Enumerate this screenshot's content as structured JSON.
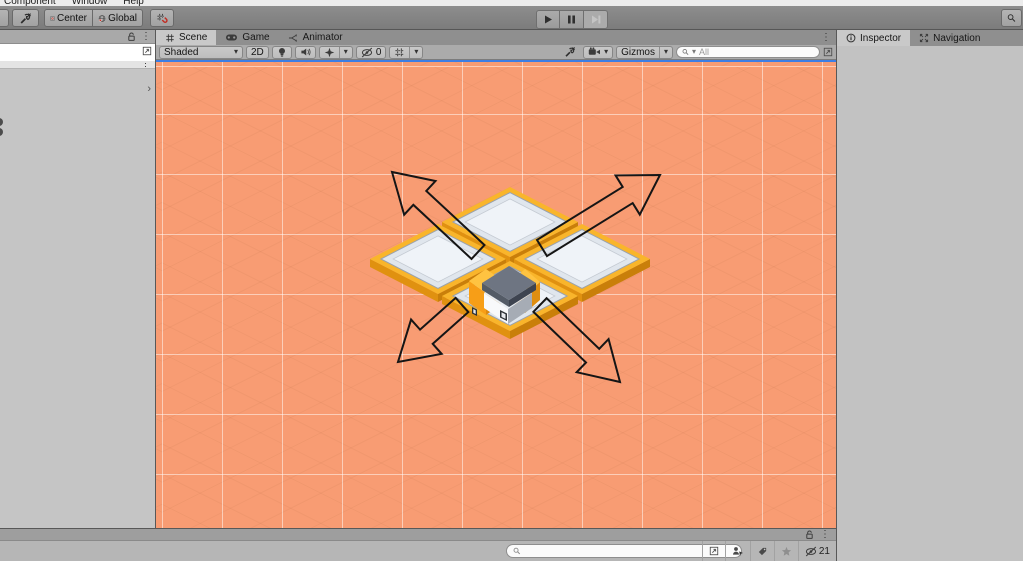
{
  "menu_bar": {
    "items": [
      "Component",
      "Window",
      "Help"
    ]
  },
  "main_toolbar": {
    "center_label": "Center",
    "global_label": "Global"
  },
  "scene_panel": {
    "tabs": [
      {
        "label": "Scene"
      },
      {
        "label": "Game"
      },
      {
        "label": "Animator"
      }
    ],
    "toolbar": {
      "draw_mode": "Shaded",
      "mode_2d_label": "2D",
      "hidden_count": "0",
      "gizmos_label": "Gizmos",
      "search_placeholder": "All",
      "search_value": ""
    }
  },
  "inspector_panel": {
    "tabs": [
      {
        "label": "Inspector"
      },
      {
        "label": "Navigation"
      }
    ]
  },
  "left_panel": {
    "search_value": "",
    "search_placeholder": ""
  },
  "bottom_panel": {
    "search_value": "",
    "search_placeholder": "",
    "hidden_count": "21"
  },
  "scene_view": {
    "tiles": 4,
    "arrows": [
      "up-left",
      "up-right",
      "down-left",
      "down-right"
    ],
    "object": "isometric-house"
  },
  "icons": {
    "kebab": "⋮",
    "caret": "▾",
    "chevron": "›"
  },
  "colors": {
    "scene_bg": "#F89C73",
    "tile_gold": "#F9B52B",
    "tile_gold_dark": "#E09110",
    "tile_gold_darker": "#C97F0A",
    "tile_top": "#E0E6ED",
    "tile_top_inner": "#EFF3F8",
    "focus_blue": "#3D7EE4",
    "arrow_outline": "#151515"
  }
}
